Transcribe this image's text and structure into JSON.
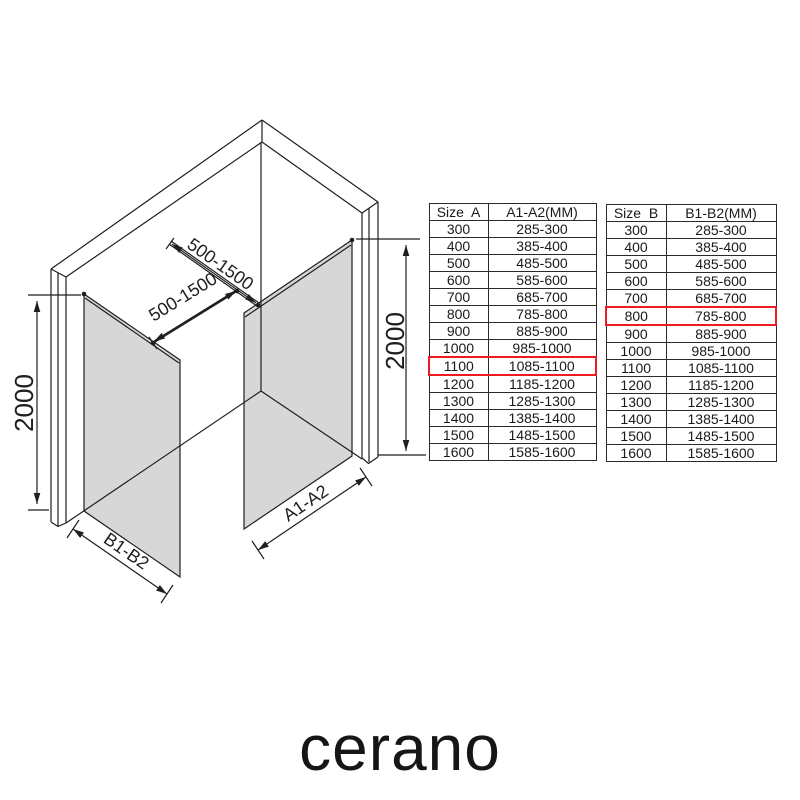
{
  "colors": {
    "red": "#ec1c24",
    "line": "#1f1f1f",
    "glass": "#d7d7d7"
  },
  "diagram": {
    "labels": {
      "bar_upper": "500-1500",
      "bar_lower": "500-1500",
      "height_left": "2000",
      "height_right": "2000",
      "bottom_left": "B1-B2",
      "bottom_right": "A1-A2"
    }
  },
  "tables": [
    {
      "size_header": "Size  A",
      "range_header": "A1-A2(MM)",
      "rows": [
        {
          "size": "300",
          "range": "285-300"
        },
        {
          "size": "400",
          "range": "385-400"
        },
        {
          "size": "500",
          "range": "485-500"
        },
        {
          "size": "600",
          "range": "585-600"
        },
        {
          "size": "700",
          "range": "685-700"
        },
        {
          "size": "800",
          "range": "785-800"
        },
        {
          "size": "900",
          "range": "885-900"
        },
        {
          "size": "1000",
          "range": "985-1000"
        },
        {
          "size": "1100",
          "range": "1085-1100",
          "highlight": true
        },
        {
          "size": "1200",
          "range": "1185-1200"
        },
        {
          "size": "1300",
          "range": "1285-1300"
        },
        {
          "size": "1400",
          "range": "1385-1400"
        },
        {
          "size": "1500",
          "range": "1485-1500"
        },
        {
          "size": "1600",
          "range": "1585-1600"
        }
      ]
    },
    {
      "size_header": "Size  B",
      "range_header": "B1-B2(MM)",
      "rows": [
        {
          "size": "300",
          "range": "285-300"
        },
        {
          "size": "400",
          "range": "385-400"
        },
        {
          "size": "500",
          "range": "485-500"
        },
        {
          "size": "600",
          "range": "585-600"
        },
        {
          "size": "700",
          "range": "685-700"
        },
        {
          "size": "800",
          "range": "785-800",
          "highlight": true
        },
        {
          "size": "900",
          "range": "885-900"
        },
        {
          "size": "1000",
          "range": "985-1000"
        },
        {
          "size": "1100",
          "range": "1085-1100"
        },
        {
          "size": "1200",
          "range": "1185-1200"
        },
        {
          "size": "1300",
          "range": "1285-1300"
        },
        {
          "size": "1400",
          "range": "1385-1400"
        },
        {
          "size": "1500",
          "range": "1485-1500"
        },
        {
          "size": "1600",
          "range": "1585-1600"
        }
      ]
    }
  ],
  "brand": {
    "logo_text": "cerano"
  }
}
